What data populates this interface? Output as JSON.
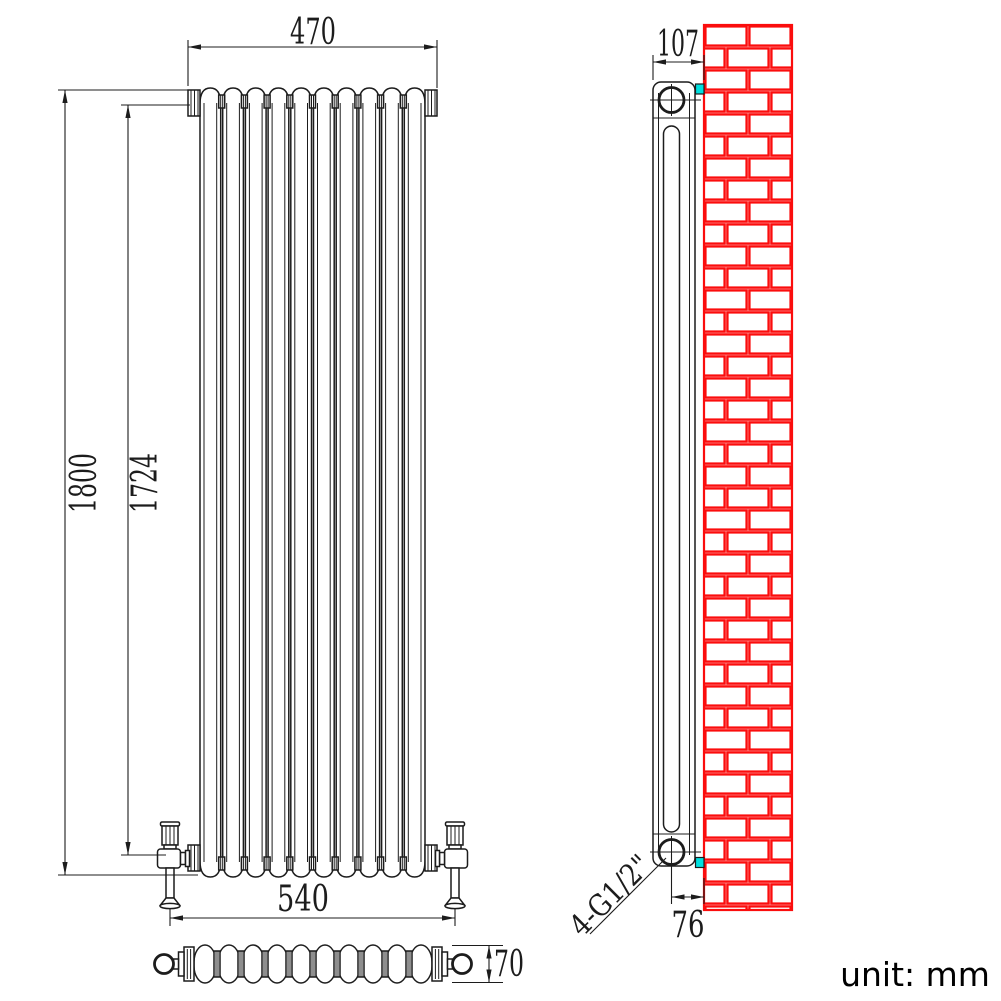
{
  "drawing": {
    "unit_label": "unit: mm",
    "front_view": {
      "top_width_mm": "470",
      "overall_height_mm": "1800",
      "pipe_centres_height_mm": "1724",
      "valve_centres_mm": "540"
    },
    "plan_view": {
      "depth_mm": "70"
    },
    "side_view": {
      "overall_depth_mm": "107",
      "wall_to_pipe_centre_mm": "76",
      "connection_label": "4-G1/2\""
    }
  },
  "colors": {
    "line": "#1c1c1c",
    "brick": "#fb0d0d",
    "bracket": "#00e0e0"
  }
}
